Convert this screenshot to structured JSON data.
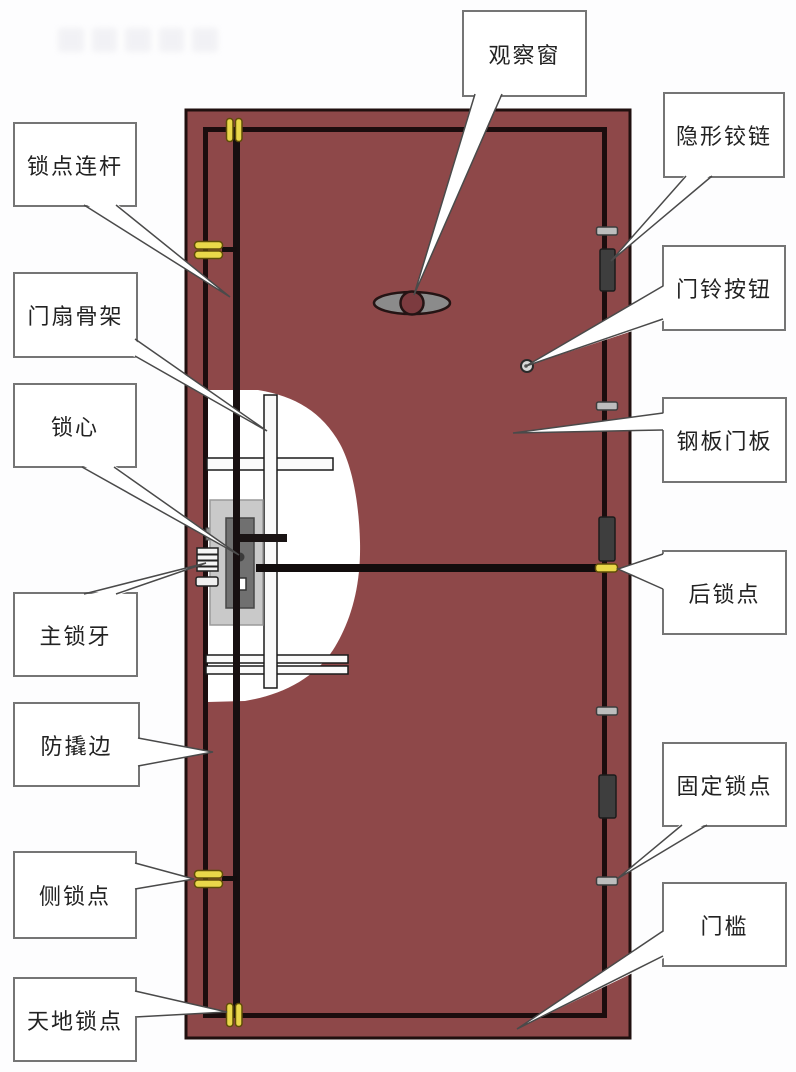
{
  "diagram": {
    "subject": "security-door-structure",
    "labels": {
      "left": [
        "锁点连杆",
        "门扇骨架",
        "锁心",
        "主锁牙",
        "防撬边",
        "侧锁点",
        "天地锁点"
      ],
      "top": [
        "观察窗"
      ],
      "right": [
        "隐形铰链",
        "门铃按钮",
        "钢板门板",
        "后锁点",
        "固定锁点",
        "门槛"
      ]
    },
    "colors": {
      "door_panel": "#8E4849",
      "door_outline": "#20100F",
      "inner_frame_line": "#1B0D0E",
      "lock_point_yellow": "#E9D84A",
      "lock_point_yellow_outline": "#5F4D08",
      "hinge_dark": "#3E3E3E",
      "hinge_pin_gray": "#BDBDBD",
      "lock_body_gray": "#C9C9C9",
      "lock_core_gray": "#707070",
      "peephole_gray": "#8B8B8B",
      "skeleton_bar": "#FAFAFA",
      "cutaway": "#FFFFFF",
      "label_border": "#757575",
      "label_text": "#222222",
      "background": "#FDFDFE"
    }
  }
}
